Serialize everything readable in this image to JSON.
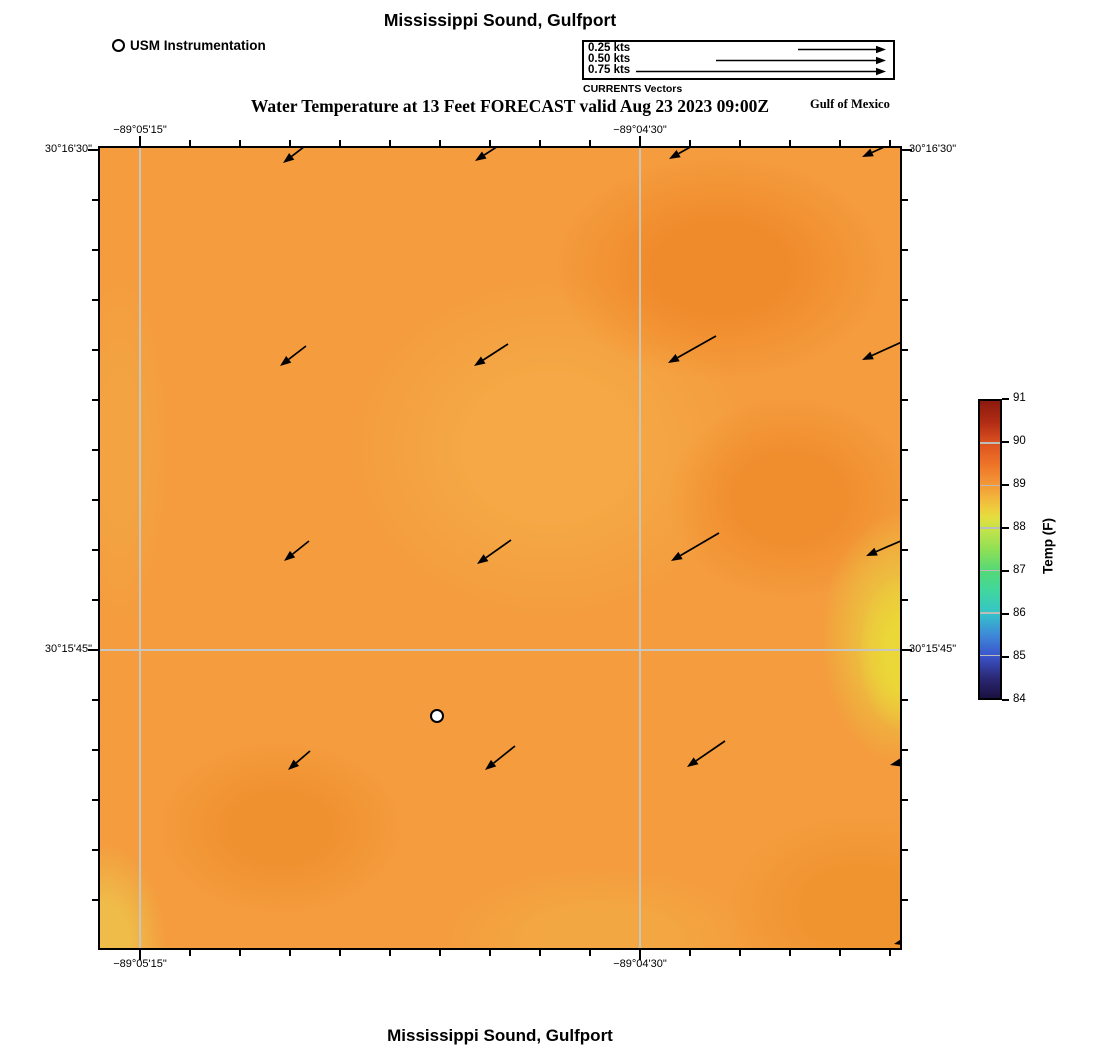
{
  "titles": {
    "top": "Mississippi Sound, Gulfport",
    "subtitle": "Water Temperature at 13 Feet FORECAST valid Aug 23 2023 09:00Z",
    "bottom": "Mississippi Sound, Gulfport",
    "region_label": "Gulf of Mexico"
  },
  "legend": {
    "instrumentation_label": "USM Instrumentation",
    "currents": {
      "caption": "CURRENTS Vectors",
      "entries": [
        {
          "label": "0.25 kts",
          "arrow_len": 88
        },
        {
          "label": "0.50 kts",
          "arrow_len": 170
        },
        {
          "label": "0.75 kts",
          "arrow_len": 250
        }
      ]
    }
  },
  "chart_data": {
    "type": "heatmap",
    "title": "Mississippi Sound, Gulfport",
    "subtitle": "Water Temperature at 13 Feet FORECAST valid Aug 23 2023 09:00Z",
    "x_axis": {
      "labels": [
        {
          "text": "−89°05'15\"",
          "px": 40
        },
        {
          "text": "−89°04'30\"",
          "px": 540
        }
      ]
    },
    "y_axis": {
      "labels": [
        {
          "text": "30°16'30\"",
          "px": 2
        },
        {
          "text": "30°15'45\"",
          "px": 502
        }
      ]
    },
    "ticks": {
      "x": {
        "start": 40,
        "step": 50,
        "count": 16,
        "major": [
          40,
          540
        ]
      },
      "y": {
        "start": 2,
        "step": 50,
        "count": 16,
        "major": [
          2,
          502
        ]
      }
    },
    "grid": {
      "v": [
        40,
        540
      ],
      "h": [
        502
      ]
    },
    "heat": {
      "base": "#F49C3E",
      "blobs": [
        {
          "x": 805,
          "y": 505,
          "rx": 65,
          "ry": 110,
          "color": "#EBD737"
        },
        {
          "x": 800,
          "y": 490,
          "rx": 110,
          "ry": 175,
          "color": "#ECC23F"
        },
        {
          "x": 5,
          "y": 800,
          "rx": 85,
          "ry": 145,
          "color": "#EFBC49"
        },
        {
          "x": 180,
          "y": 680,
          "rx": 170,
          "ry": 120,
          "color": "#F0912F"
        },
        {
          "x": 620,
          "y": 120,
          "rx": 230,
          "ry": 155,
          "color": "#F08B2B"
        },
        {
          "x": 690,
          "y": 350,
          "rx": 170,
          "ry": 140,
          "color": "#F08D2D"
        },
        {
          "x": 760,
          "y": 760,
          "rx": 185,
          "ry": 130,
          "color": "#F0942F"
        },
        {
          "x": 500,
          "y": 790,
          "rx": 220,
          "ry": 100,
          "color": "#F3A742"
        },
        {
          "x": 450,
          "y": 300,
          "rx": 280,
          "ry": 240,
          "color": "#F5A845"
        },
        {
          "x": 20,
          "y": 300,
          "rx": 70,
          "ry": 250,
          "color": "#F3A342"
        }
      ]
    },
    "temperature_grid_f": {
      "note": "approximate field values read against colorbar, rows top to bottom",
      "values": [
        [
          89.1,
          89.0,
          89.0,
          89.3,
          89.3
        ],
        [
          89.0,
          88.9,
          89.0,
          89.4,
          89.2
        ],
        [
          89.0,
          88.9,
          89.0,
          89.3,
          88.3
        ],
        [
          88.9,
          89.2,
          89.0,
          89.1,
          88.5
        ],
        [
          88.6,
          89.1,
          89.0,
          89.2,
          89.1
        ]
      ]
    },
    "current_vectors": [
      {
        "x": 183,
        "y": 15,
        "dx": 26,
        "dy": -20,
        "speed_kts": 0.1
      },
      {
        "x": 375,
        "y": 13,
        "dx": 34,
        "dy": -22,
        "speed_kts": 0.12
      },
      {
        "x": 569,
        "y": 11,
        "dx": 48,
        "dy": -27,
        "speed_kts": 0.16
      },
      {
        "x": 762,
        "y": 9,
        "dx": 62,
        "dy": -28,
        "speed_kts": 0.2
      },
      {
        "x": 180,
        "y": 218,
        "dx": 26,
        "dy": -20,
        "speed_kts": 0.1
      },
      {
        "x": 374,
        "y": 218,
        "dx": 34,
        "dy": -22,
        "speed_kts": 0.12
      },
      {
        "x": 568,
        "y": 215,
        "dx": 48,
        "dy": -27,
        "speed_kts": 0.16
      },
      {
        "x": 762,
        "y": 212,
        "dx": 62,
        "dy": -28,
        "speed_kts": 0.2
      },
      {
        "x": 184,
        "y": 413,
        "dx": 25,
        "dy": -20,
        "speed_kts": 0.1
      },
      {
        "x": 377,
        "y": 416,
        "dx": 34,
        "dy": -24,
        "speed_kts": 0.12
      },
      {
        "x": 571,
        "y": 413,
        "dx": 48,
        "dy": -28,
        "speed_kts": 0.17
      },
      {
        "x": 766,
        "y": 408,
        "dx": 60,
        "dy": -26,
        "speed_kts": 0.19
      },
      {
        "x": 188,
        "y": 622,
        "dx": 22,
        "dy": -19,
        "speed_kts": 0.09
      },
      {
        "x": 385,
        "y": 622,
        "dx": 30,
        "dy": -24,
        "speed_kts": 0.11
      },
      {
        "x": 587,
        "y": 619,
        "dx": 38,
        "dy": -26,
        "speed_kts": 0.14
      },
      {
        "x": 790,
        "y": 617,
        "dx": 44,
        "dy": -10,
        "speed_kts": 0.13
      },
      {
        "x": 794,
        "y": 796,
        "dx": 34,
        "dy": -8,
        "speed_kts": 0.1
      }
    ],
    "station": {
      "x": 337,
      "y": 568,
      "name": "USM Instrumentation"
    },
    "colorbar": {
      "label": "Temp (F)",
      "min": 84,
      "max": 91,
      "tick_values": [
        84,
        85,
        86,
        87,
        88,
        89,
        90,
        91
      ],
      "stops": [
        {
          "p": 0,
          "c": "#1B1040"
        },
        {
          "p": 7,
          "c": "#2C2A78"
        },
        {
          "p": 14.3,
          "c": "#3B55CC"
        },
        {
          "p": 21.4,
          "c": "#3E8AD8"
        },
        {
          "p": 28.6,
          "c": "#35C4C8"
        },
        {
          "p": 35.7,
          "c": "#3FD6A0"
        },
        {
          "p": 42.9,
          "c": "#55D977"
        },
        {
          "p": 50,
          "c": "#8FE055"
        },
        {
          "p": 57.1,
          "c": "#C6E44A"
        },
        {
          "p": 61,
          "c": "#E6DD3E"
        },
        {
          "p": 64.3,
          "c": "#F0C93E"
        },
        {
          "p": 71.4,
          "c": "#F49B38"
        },
        {
          "p": 78.6,
          "c": "#EE7428"
        },
        {
          "p": 85.7,
          "c": "#DD5220"
        },
        {
          "p": 92.9,
          "c": "#B02C14"
        },
        {
          "p": 100,
          "c": "#8C1A0E"
        }
      ]
    }
  }
}
